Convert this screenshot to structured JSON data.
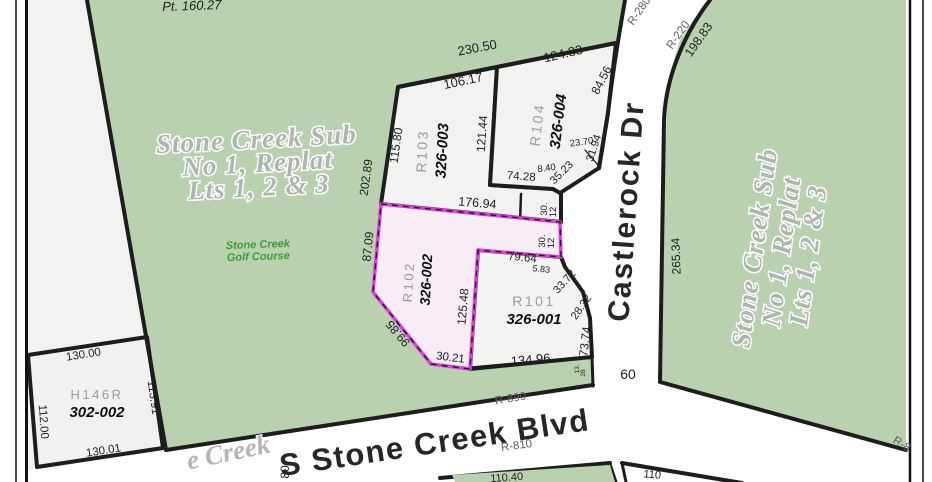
{
  "map_title": "parcel-plat-map",
  "colors": {
    "greenspace": "#b9d1ae",
    "parcel_fill": "#f2f2f1",
    "boundary": "#1d1d1d",
    "highlight_stroke": "#e23be2",
    "highlight_fill": "#f6edf5"
  },
  "labels": {
    "pt": "Pt. 160.27",
    "sub1": "Stone Creek Sub",
    "sub2": "No 1, Replat",
    "sub3": "Lts 1, 2 & 3",
    "golf1": "Stone Creek",
    "golf2": "Golf Course",
    "creek": "e Creek",
    "castlerock": "Castlerock Dr",
    "blvd": "S Stone Creek Blvd",
    "r890": "R-890",
    "r810": "R-810",
    "r280": "R-280",
    "r220": "R-220",
    "r8": "R-8",
    "road_width": "60"
  },
  "parcels": {
    "r103": {
      "id": "R103",
      "apn": "326-003"
    },
    "r104": {
      "id": "R104",
      "apn": "326-004"
    },
    "r102": {
      "id": "R102",
      "apn": "326-002",
      "selected": true
    },
    "r101": {
      "id": "R101",
      "apn": "326-001"
    },
    "h146r": {
      "id": "H146R",
      "apn": "302-002"
    }
  },
  "dims": {
    "block_top": "230.50",
    "r103_top": "106.17",
    "r104_top": "124.33",
    "r104_ne": "84.56",
    "r103_w": "115.80",
    "green_edge": "202.89",
    "r103_e": "121.44",
    "r104_e": "31.94",
    "r104_c1": "23.70",
    "r104_se": "35.23",
    "r104_jog": "8.40",
    "r104_s": "74.28",
    "r102_top": "176.94",
    "r102_w": "87.09",
    "step_a": "30.",
    "step_b": "12",
    "r102_arm": "79.64",
    "r101_jog": "5.83",
    "r101_ne1": "33.72",
    "r101_ne2": "28.32",
    "r101_e": "73.74",
    "r102_e": "125.48",
    "r102_sw": "99.85",
    "r102_s": "30.21",
    "r101_s": "134.96",
    "castlerock_curve": "198.83",
    "green_w": "265.34",
    "h_top": "130.00",
    "h_e": "113.91",
    "h_w": "112.00",
    "h_s": "130.01",
    "sliver_a": "13.",
    "sliver_b": "28",
    "lot_b1": "110.40",
    "lot_b2": "110",
    "creek_num": "80"
  }
}
